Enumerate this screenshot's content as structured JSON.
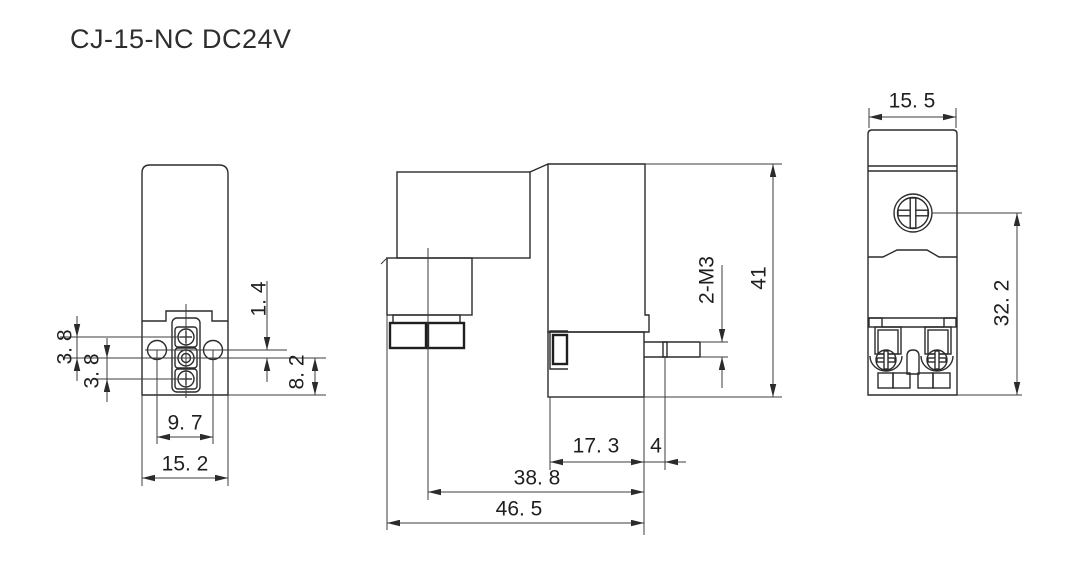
{
  "title": "CJ-15-NC DC24V",
  "views": {
    "left": {
      "dims": {
        "terminal_pitch_top": "3. 8",
        "terminal_pitch_bottom": "3. 8",
        "hole_to_terminal_offset": "1. 4",
        "terminal_to_base": "8. 2",
        "hole_spacing": "9. 7",
        "width": "15. 2"
      }
    },
    "front": {
      "dims": {
        "port_offset": "17. 3",
        "port_stub": "4",
        "body_length": "38. 8",
        "overall_length": "46. 5",
        "overall_height": "41",
        "thread_spec": "2-M3"
      }
    },
    "side": {
      "dims": {
        "width": "15. 5",
        "screw_to_base": "32. 2"
      }
    }
  }
}
